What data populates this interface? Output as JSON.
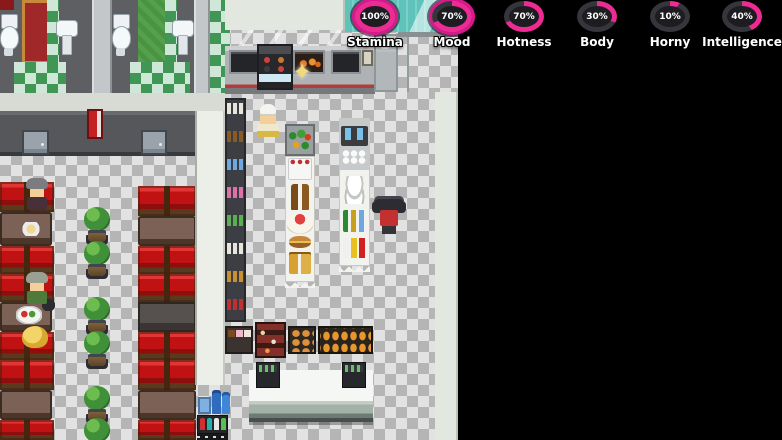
{
  "hud": {
    "stats": [
      {
        "label": "Stamina",
        "percent": 100,
        "value_text": "100%",
        "highlighted": true
      },
      {
        "label": "Mood",
        "percent": 70,
        "value_text": "70%",
        "highlighted": true
      },
      {
        "label": "Hotness",
        "percent": 70,
        "value_text": "70%",
        "highlighted": false
      },
      {
        "label": "Body",
        "percent": 30,
        "value_text": "30%",
        "highlighted": false
      },
      {
        "label": "Horny",
        "percent": 10,
        "value_text": "10%",
        "highlighted": false
      },
      {
        "label": "Intelligence",
        "percent": 40,
        "value_text": "40%",
        "highlighted": false
      }
    ],
    "colors": {
      "progress_arc": "#ee2a93",
      "ring_track": "#35353c",
      "gauge_center": "#1c1c21",
      "highlight_ring": "#d61a8d",
      "label_text": "#ffffff"
    }
  },
  "icons": {
    "sparkle": "✦"
  }
}
